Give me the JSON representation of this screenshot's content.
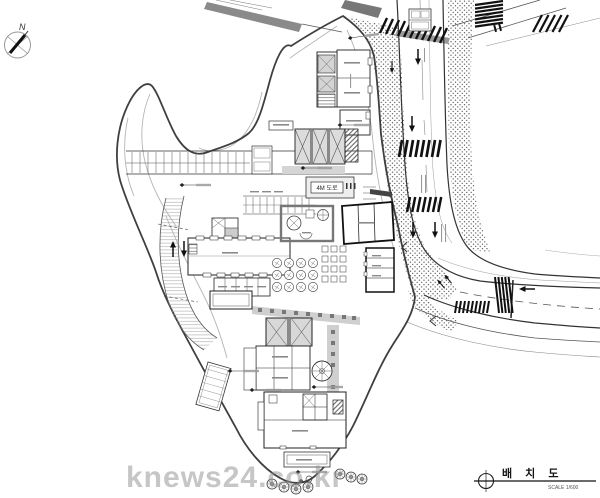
{
  "compass": {
    "label": "N"
  },
  "plan": {
    "road_label": "4M 도로"
  },
  "titleblock": {
    "title": "배 치 도",
    "scale": "SCALE 1/600"
  },
  "watermark": {
    "text": "knews24.co.kr"
  },
  "colors": {
    "ink": "#2b2b2b",
    "boundary": "#3f3f3f",
    "light_line": "#b5b5b5",
    "gray_fill": "#d8d8d8",
    "dark_fill": "#8a8a8a",
    "watermark": "#8e8e8e"
  }
}
